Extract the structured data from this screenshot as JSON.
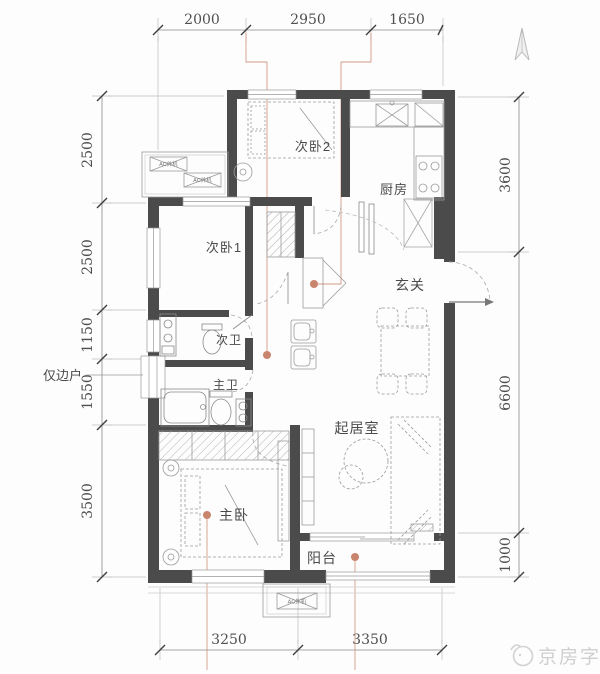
{
  "rooms": {
    "bedroom2": "次卧2",
    "kitchen": "厨房",
    "bedroom1": "次卧1",
    "foyer": "玄关",
    "bath2": "次卫",
    "bath1": "主卫",
    "living": "起居室",
    "master": "主卧",
    "balcony": "阳台"
  },
  "dimensions": {
    "top": [
      "2000",
      "2950",
      "1650"
    ],
    "left": [
      "2500",
      "2500",
      "1150",
      "1550",
      "3500"
    ],
    "right": [
      "3600",
      "6600",
      "1000"
    ],
    "bottom": [
      "3250",
      "3350"
    ]
  },
  "annotations": {
    "edge_note": "仅边户",
    "ac_label": "AC外机",
    "watermark": "京房字"
  },
  "colors": {
    "wall": "#4b4b4b",
    "furniture_line": "#9b9b9b",
    "dimension_text": "#4f4f4f",
    "accent_marker": "#c9846d",
    "watermark_gray": "#cfcfcf"
  }
}
